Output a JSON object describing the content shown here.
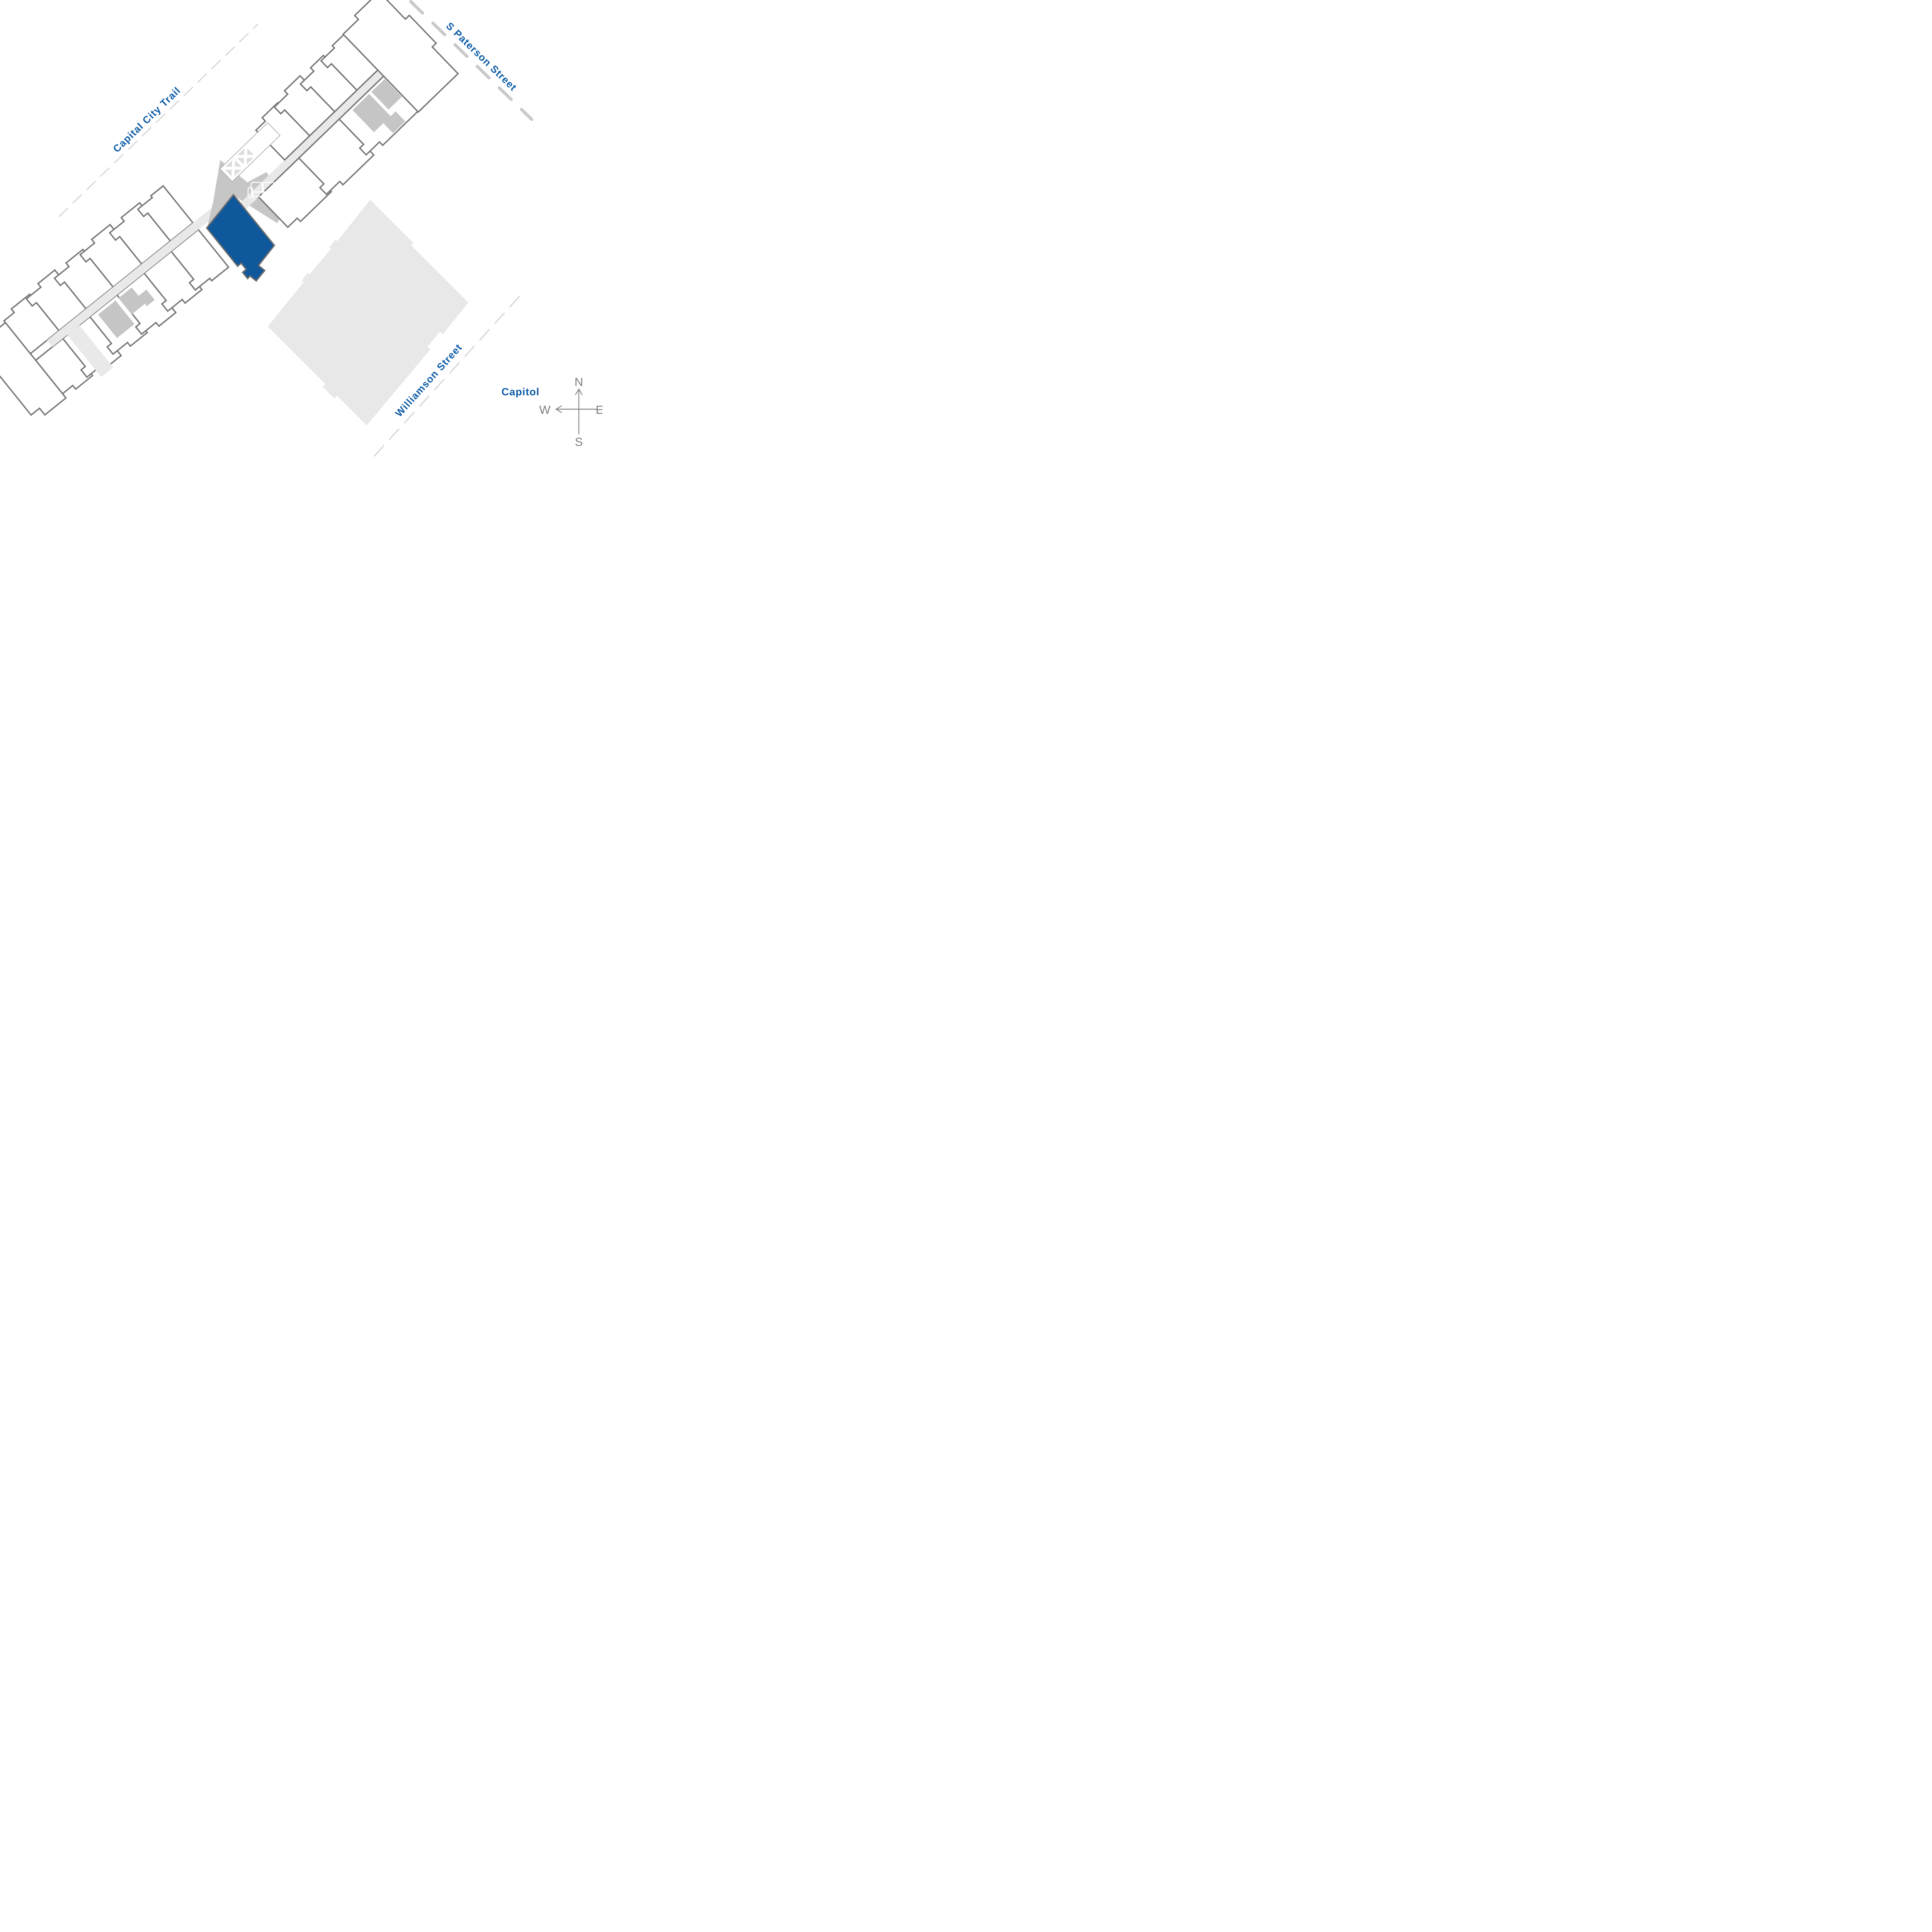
{
  "plan": {
    "streets": [
      {
        "id": "capital-city-trail",
        "label": "Capital City Trail"
      },
      {
        "id": "s-paterson-street",
        "label": "S Paterson Street"
      },
      {
        "id": "williamson-street",
        "label": "Williamson Street"
      }
    ],
    "landmark": {
      "label": "Capitol"
    },
    "compass": {
      "north": "N",
      "east": "E",
      "south": "S",
      "west": "W"
    },
    "selected_unit": {
      "state": "selected"
    },
    "icons": {
      "couch": "couch-icon",
      "stairs": "stairs-cross-icon"
    },
    "colors": {
      "label_blue": "#0e5ca8",
      "unit_selected_blue": "#0f589c",
      "outline_gray": "#787878",
      "corridor_gray": "#e9e9e9",
      "lobby_gray": "#c6c6c6",
      "service_gray": "#c5c5c5",
      "neighbor_building_gray": "#e8e8e8",
      "street_dash_gray": "#d6d6d6",
      "street_dash_thick_gray": "#c9c9c9",
      "compass_gray": "#808080"
    }
  }
}
